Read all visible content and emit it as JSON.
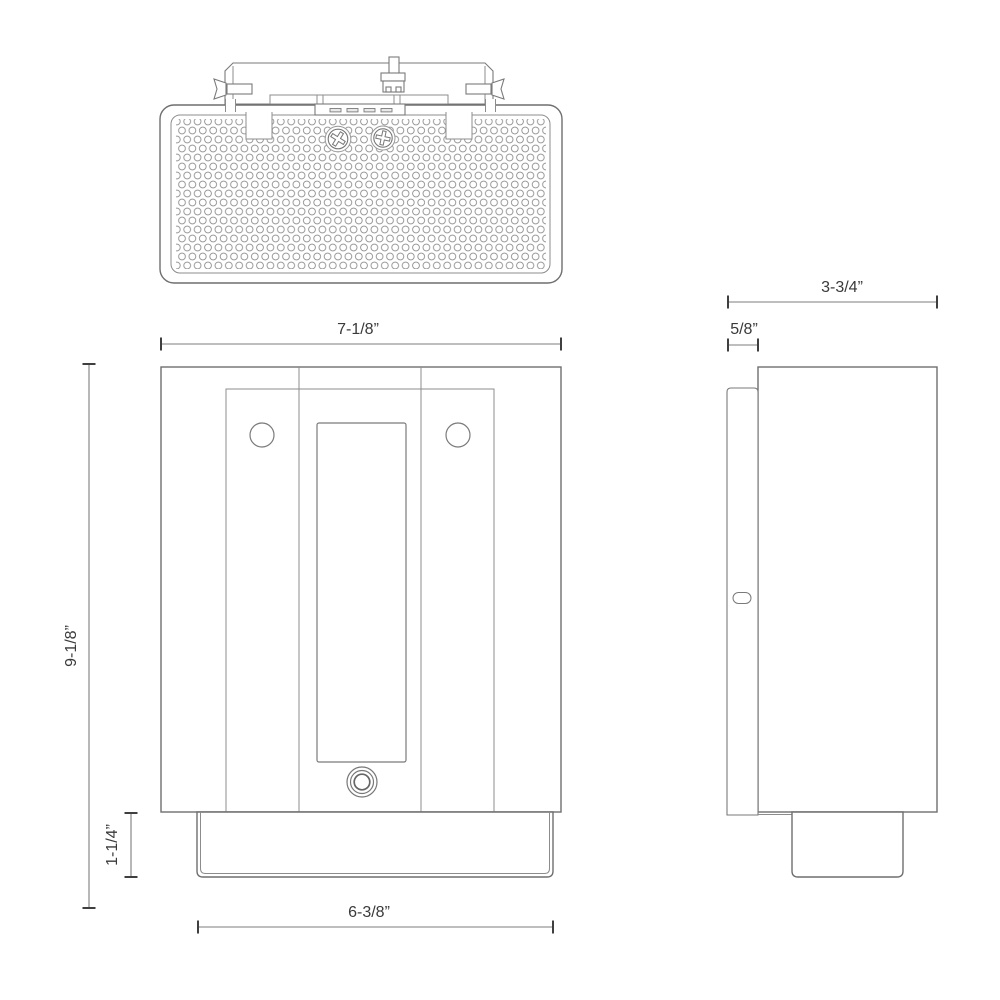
{
  "drawing": {
    "kind": "wall-sconce-spec-drawing",
    "colors": {
      "background": "#ffffff",
      "outline": "#6f6f6f",
      "secondary_line": "#8c8c8c",
      "dimension_line": "#7d7d7d",
      "text": "#3a3a3a"
    },
    "views": {
      "top": {
        "name": "top view"
      },
      "front": {
        "name": "front view",
        "dimensions": {
          "width": "7-1/8”",
          "height": "9-1/8”",
          "base_height": "1-1/4”",
          "base_width": "6-3/8”"
        }
      },
      "side": {
        "name": "side view",
        "dimensions": {
          "depth": "3-3/4”",
          "wall_plate_depth": "5/8”"
        }
      }
    }
  }
}
